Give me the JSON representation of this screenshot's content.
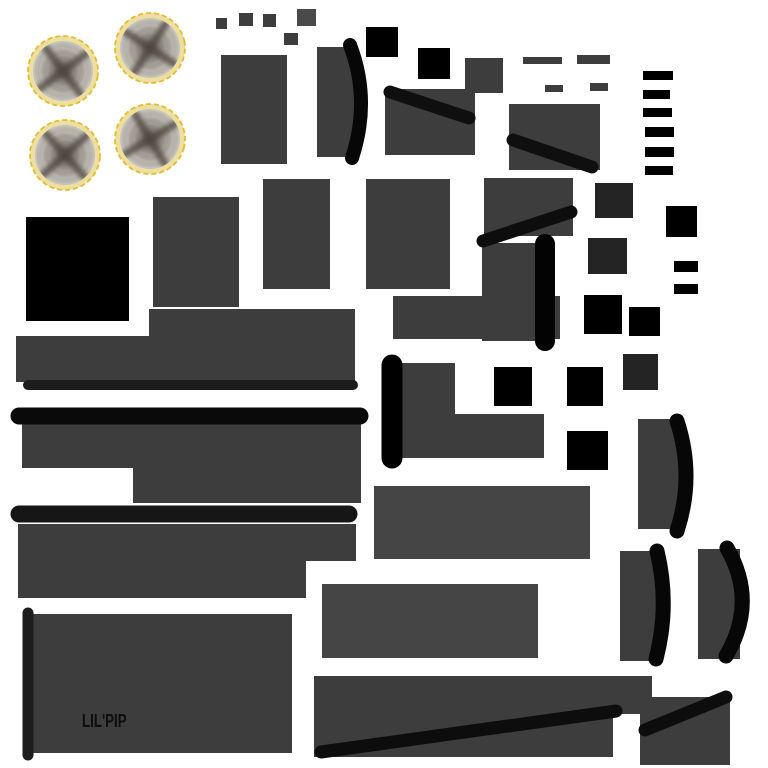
{
  "canvas": {
    "width": 768,
    "height": 768,
    "background": "#ffffff"
  },
  "texture_label": {
    "text": "LIL'PIP",
    "color": "#0d0d0d",
    "x": 82,
    "y": 712
  },
  "palette": {
    "gray": "#3d3d3d",
    "gray_light": "#454545",
    "gray_lighter": "#4a4a4a",
    "dark": "#242424",
    "black": "#000000",
    "band": "#070707",
    "rim_outer": "#e5bc2e",
    "rim_inner": "#ecdfa0",
    "disc_center": "#544e47",
    "disc_edge": "#c8c5bf",
    "cross": "#4a433b"
  },
  "wheels": {
    "r": 34,
    "items": [
      {
        "name": "wheel-top-left",
        "cx": 63,
        "cy": 71,
        "rot": 8
      },
      {
        "name": "wheel-top-right",
        "cx": 150,
        "cy": 48,
        "rot": -12
      },
      {
        "name": "wheel-bot-left",
        "cx": 65,
        "cy": 155,
        "rot": 3
      },
      {
        "name": "wheel-bot-right",
        "cx": 150,
        "cy": 139,
        "rot": 14
      }
    ]
  },
  "rects": [
    {
      "name": "panel-a",
      "x": 221,
      "y": 55,
      "w": 66,
      "h": 109,
      "color": "gray"
    },
    {
      "name": "curved-rect-a",
      "x": 317,
      "y": 47,
      "w": 40,
      "h": 110,
      "color": "gray"
    },
    {
      "name": "panel-b",
      "x": 385,
      "y": 89,
      "w": 90,
      "h": 66,
      "color": "gray"
    },
    {
      "name": "panel-c",
      "x": 509,
      "y": 104,
      "w": 91,
      "h": 66,
      "color": "gray"
    },
    {
      "name": "panel-d",
      "x": 263,
      "y": 179,
      "w": 67,
      "h": 110,
      "color": "gray"
    },
    {
      "name": "panel-e",
      "x": 366,
      "y": 179,
      "w": 84,
      "h": 110,
      "color": "gray"
    },
    {
      "name": "panel-f",
      "x": 484,
      "y": 178,
      "w": 89,
      "h": 58,
      "color": "gray"
    },
    {
      "name": "curved-rect-b",
      "x": 482,
      "y": 243,
      "w": 63,
      "h": 98,
      "color": "gray"
    },
    {
      "name": "panel-g",
      "x": 153,
      "y": 197,
      "w": 86,
      "h": 110,
      "color": "gray"
    },
    {
      "name": "panel-h",
      "x": 393,
      "y": 296,
      "w": 167,
      "h": 43,
      "color": "gray"
    },
    {
      "name": "step-a-top",
      "x": 149,
      "y": 309,
      "w": 206,
      "h": 28,
      "color": "gray"
    },
    {
      "name": "step-a-bottom",
      "x": 16,
      "y": 336,
      "w": 339,
      "h": 46,
      "color": "gray"
    },
    {
      "name": "step-b-top",
      "x": 22,
      "y": 424,
      "w": 339,
      "h": 44,
      "color": "gray"
    },
    {
      "name": "step-b-bottom",
      "x": 133,
      "y": 468,
      "w": 228,
      "h": 35,
      "color": "gray"
    },
    {
      "name": "lshape-top",
      "x": 389,
      "y": 363,
      "w": 66,
      "h": 52,
      "color": "gray"
    },
    {
      "name": "lshape-bottom",
      "x": 389,
      "y": 414,
      "w": 155,
      "h": 44,
      "color": "gray"
    },
    {
      "name": "step-c-top",
      "x": 18,
      "y": 524,
      "w": 338,
      "h": 37,
      "color": "gray"
    },
    {
      "name": "step-c-bottom",
      "x": 18,
      "y": 560,
      "w": 288,
      "h": 38,
      "color": "gray"
    },
    {
      "name": "panel-i",
      "x": 374,
      "y": 486,
      "w": 216,
      "h": 73,
      "color": "gray_light"
    },
    {
      "name": "panel-j",
      "x": 322,
      "y": 584,
      "w": 216,
      "h": 74,
      "color": "gray_light"
    },
    {
      "name": "label-panel",
      "x": 33,
      "y": 614,
      "w": 259,
      "h": 139,
      "color": "gray"
    },
    {
      "name": "step-d-top",
      "x": 314,
      "y": 676,
      "w": 338,
      "h": 38,
      "color": "gray"
    },
    {
      "name": "step-d-bottom",
      "x": 314,
      "y": 713,
      "w": 299,
      "h": 44,
      "color": "gray"
    },
    {
      "name": "panel-k",
      "x": 640,
      "y": 697,
      "w": 90,
      "h": 68,
      "color": "gray"
    },
    {
      "name": "curved-rect-c",
      "x": 638,
      "y": 419,
      "w": 45,
      "h": 110,
      "color": "gray"
    },
    {
      "name": "curved-rect-d",
      "x": 620,
      "y": 551,
      "w": 42,
      "h": 110,
      "color": "gray"
    },
    {
      "name": "curved-rect-e",
      "x": 698,
      "y": 549,
      "w": 42,
      "h": 110,
      "color": "gray"
    },
    {
      "name": "small-sq-1",
      "x": 216,
      "y": 18,
      "w": 11,
      "h": 11,
      "color": "gray"
    },
    {
      "name": "small-sq-2",
      "x": 239,
      "y": 13,
      "w": 14,
      "h": 13,
      "color": "gray"
    },
    {
      "name": "small-sq-3",
      "x": 263,
      "y": 14,
      "w": 13,
      "h": 13,
      "color": "gray"
    },
    {
      "name": "small-sq-4",
      "x": 297,
      "y": 9,
      "w": 19,
      "h": 17,
      "color": "gray_lighter"
    },
    {
      "name": "small-sq-5",
      "x": 284,
      "y": 33,
      "w": 14,
      "h": 12,
      "color": "gray"
    },
    {
      "name": "small-panel-a",
      "x": 465,
      "y": 58,
      "w": 38,
      "h": 35,
      "color": "gray"
    },
    {
      "name": "tab-a",
      "x": 523,
      "y": 57,
      "w": 39,
      "h": 7,
      "color": "gray"
    },
    {
      "name": "tab-b",
      "x": 577,
      "y": 55,
      "w": 33,
      "h": 9,
      "color": "gray"
    },
    {
      "name": "tab-c",
      "x": 545,
      "y": 85,
      "w": 18,
      "h": 7,
      "color": "gray"
    },
    {
      "name": "tab-d",
      "x": 590,
      "y": 83,
      "w": 18,
      "h": 8,
      "color": "gray"
    },
    {
      "name": "dark-sq-1",
      "x": 595,
      "y": 183,
      "w": 38,
      "h": 35,
      "color": "dark"
    },
    {
      "name": "dark-sq-2",
      "x": 588,
      "y": 238,
      "w": 39,
      "h": 36,
      "color": "dark"
    },
    {
      "name": "dark-sq-3",
      "x": 623,
      "y": 354,
      "w": 35,
      "h": 36,
      "color": "dark"
    },
    {
      "name": "black-sq-big",
      "x": 26,
      "y": 217,
      "w": 103,
      "h": 104,
      "color": "black"
    },
    {
      "name": "black-sq-1",
      "x": 366,
      "y": 27,
      "w": 32,
      "h": 30,
      "color": "black"
    },
    {
      "name": "black-sq-2",
      "x": 418,
      "y": 48,
      "w": 32,
      "h": 31,
      "color": "black"
    },
    {
      "name": "black-sq-3",
      "x": 666,
      "y": 206,
      "w": 31,
      "h": 31,
      "color": "black"
    },
    {
      "name": "black-sq-4",
      "x": 584,
      "y": 295,
      "w": 38,
      "h": 39,
      "color": "black"
    },
    {
      "name": "black-sq-5",
      "x": 629,
      "y": 307,
      "w": 31,
      "h": 29,
      "color": "black"
    },
    {
      "name": "black-sq-6",
      "x": 494,
      "y": 367,
      "w": 38,
      "h": 39,
      "color": "black"
    },
    {
      "name": "black-sq-7",
      "x": 567,
      "y": 367,
      "w": 36,
      "h": 39,
      "color": "black"
    },
    {
      "name": "black-sq-8",
      "x": 567,
      "y": 431,
      "w": 41,
      "h": 39,
      "color": "black"
    },
    {
      "name": "rung-1",
      "x": 643,
      "y": 71,
      "w": 30,
      "h": 9,
      "color": "black"
    },
    {
      "name": "rung-2",
      "x": 643,
      "y": 90,
      "w": 27,
      "h": 9,
      "color": "black"
    },
    {
      "name": "rung-3",
      "x": 643,
      "y": 108,
      "w": 29,
      "h": 9,
      "color": "black"
    },
    {
      "name": "rung-4",
      "x": 645,
      "y": 127,
      "w": 29,
      "h": 10,
      "color": "black"
    },
    {
      "name": "rung-5",
      "x": 645,
      "y": 147,
      "w": 29,
      "h": 10,
      "color": "black"
    },
    {
      "name": "rung-6",
      "x": 645,
      "y": 166,
      "w": 28,
      "h": 9,
      "color": "black"
    },
    {
      "name": "clip-a",
      "x": 674,
      "y": 261,
      "w": 24,
      "h": 11,
      "color": "black"
    },
    {
      "name": "clip-b",
      "x": 674,
      "y": 284,
      "w": 24,
      "h": 10,
      "color": "black"
    }
  ],
  "lines": [
    {
      "name": "underline-bar",
      "x1": 28,
      "y1": 385,
      "x2": 353,
      "y2": 385,
      "w": 10,
      "color": "#1c1c1c"
    },
    {
      "name": "axle-bar-a",
      "x1": 19,
      "y1": 416,
      "x2": 360,
      "y2": 416,
      "w": 17,
      "color": "#0a0a0a"
    },
    {
      "name": "axle-bar-b",
      "x1": 19,
      "y1": 514,
      "x2": 349,
      "y2": 514,
      "w": 17,
      "color": "#161616"
    },
    {
      "name": "label-edge-bar",
      "x1": 28,
      "y1": 613,
      "x2": 28,
      "y2": 755,
      "w": 11,
      "color": "#1d1d1d"
    },
    {
      "name": "vbar-a",
      "x1": 392,
      "y1": 365,
      "x2": 392,
      "y2": 458,
      "w": 21,
      "color": "#000000"
    },
    {
      "name": "vbar-b",
      "x1": 545,
      "y1": 244,
      "x2": 545,
      "y2": 341,
      "w": 20,
      "color": "#030303"
    },
    {
      "name": "diag-bar-a",
      "x1": 390,
      "y1": 92,
      "x2": 469,
      "y2": 118,
      "w": 13,
      "color": "#0f0f0f"
    },
    {
      "name": "diag-bar-b",
      "x1": 513,
      "y1": 140,
      "x2": 592,
      "y2": 167,
      "w": 13,
      "color": "#0f0f0f"
    },
    {
      "name": "diag-bar-c",
      "x1": 483,
      "y1": 241,
      "x2": 571,
      "y2": 212,
      "w": 13,
      "color": "#0d0d0d"
    },
    {
      "name": "diag-bar-d",
      "x1": 321,
      "y1": 752,
      "x2": 616,
      "y2": 711,
      "w": 13,
      "color": "#0d0d0d"
    },
    {
      "name": "diag-bar-e",
      "x1": 645,
      "y1": 730,
      "x2": 726,
      "y2": 697,
      "w": 13,
      "color": "#0d0d0d"
    }
  ],
  "curves": [
    {
      "name": "curve-band-a",
      "d": "M350 45 Q371 100 352 158",
      "w": 14
    },
    {
      "name": "curve-band-b",
      "d": "M677 421 Q695 476 677 531",
      "w": 15
    },
    {
      "name": "curve-band-c",
      "d": "M657 551 Q670 605 656 659",
      "w": 15
    },
    {
      "name": "curve-band-d",
      "d": "M727 548 Q758 602 726 656",
      "w": 15
    }
  ]
}
